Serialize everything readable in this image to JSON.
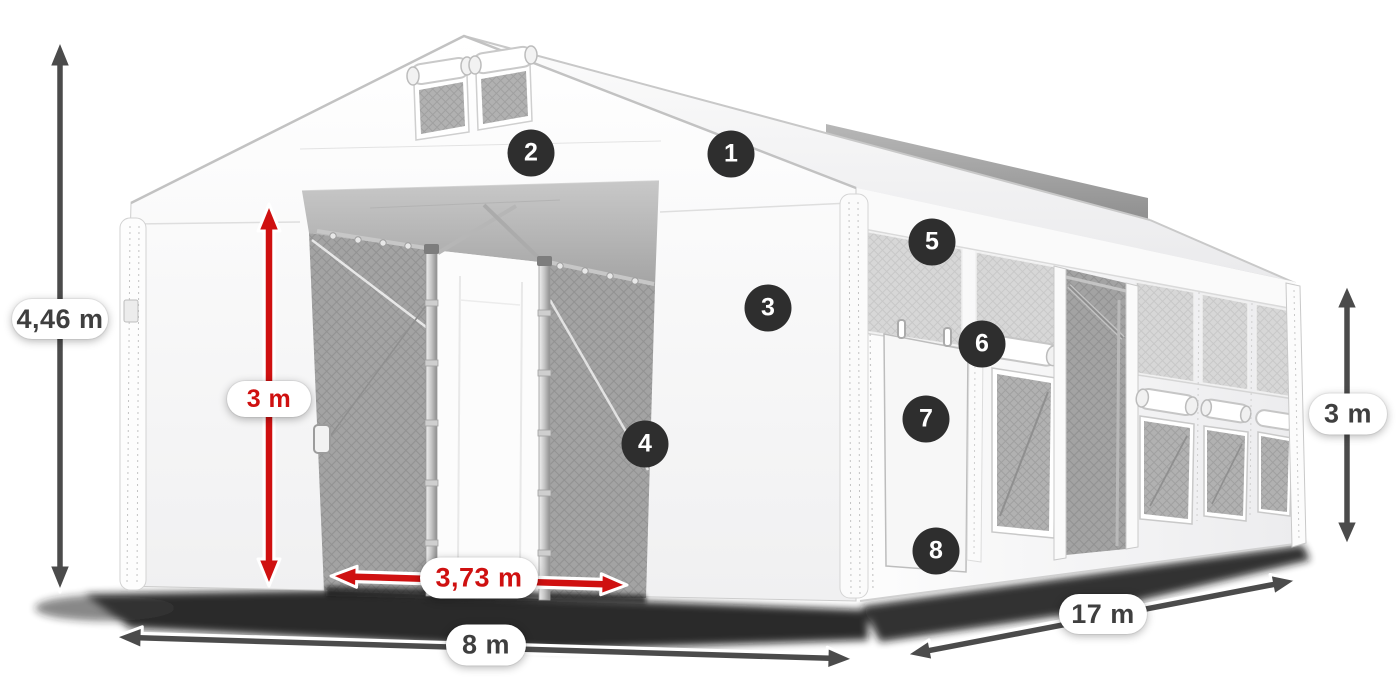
{
  "illustration": {
    "colors": {
      "dimension_arrow_dark": "#4b4b4b",
      "dimension_arrow_red": "#cf1010",
      "label_pill_background": "#ffffff",
      "label_text_dark": "#3f3f3f",
      "label_text_red": "#cf1010",
      "callout_background": "#2e2e2e",
      "callout_text": "#ffffff",
      "tent_fabric": "#ffffff",
      "mesh_fabric": "#a8a8a8"
    },
    "dimension_labels": {
      "total_height": "4,46 m",
      "inner_height": "3 m",
      "door_width": "3,73 m",
      "front_width": "8 m",
      "length": "17 m",
      "side_height": "3 m"
    },
    "callouts": [
      "1",
      "2",
      "3",
      "4",
      "5",
      "6",
      "7",
      "8"
    ]
  }
}
